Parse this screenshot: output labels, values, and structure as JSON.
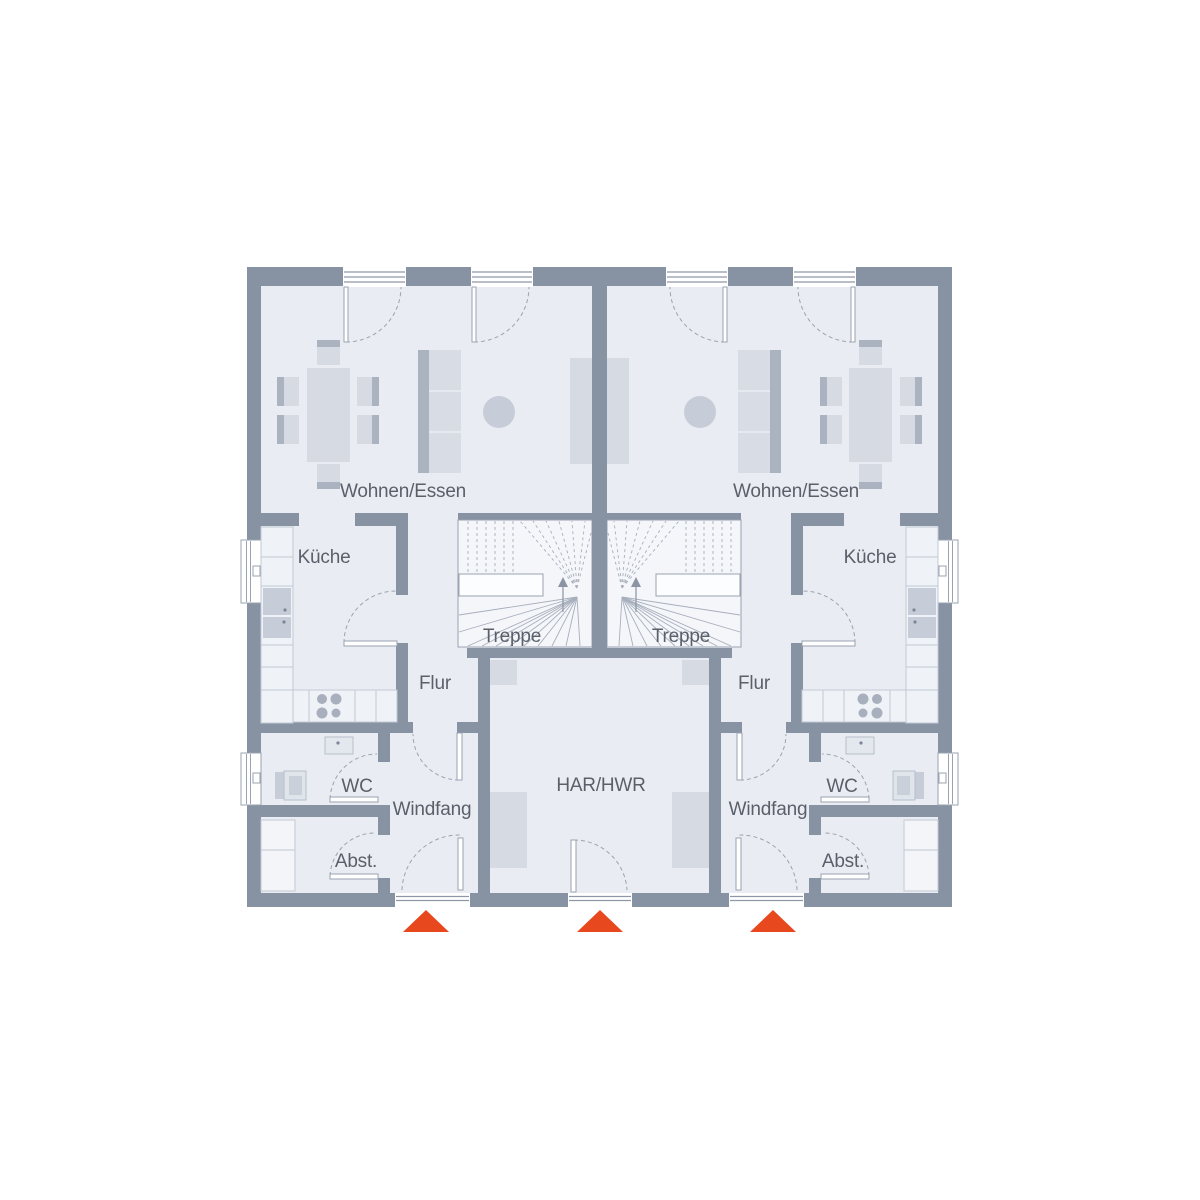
{
  "plan": {
    "type": "floor-plan",
    "description": "Erdgeschoss Doppelhaus (ground floor duplex), two mirrored units with shared central utility room",
    "labels": {
      "left": {
        "living": "Wohnen/Essen",
        "kitchen": "Küche",
        "stairs": "Treppe",
        "hall": "Flur",
        "wc": "WC",
        "vestibule": "Windfang",
        "storage": "Abst."
      },
      "right": {
        "living": "Wohnen/Essen",
        "kitchen": "Küche",
        "stairs": "Treppe",
        "hall": "Flur",
        "wc": "WC",
        "vestibule": "Windfang",
        "storage": "Abst."
      },
      "center": {
        "utility": "HAR/HWR"
      }
    },
    "entrance_arrows": 3,
    "colors": {
      "wall": "#8793A3",
      "floor": "#E9EDF3",
      "furniture": "#D5DAE3",
      "furniture_dark": "#ABB3C1",
      "counter": "#EFF2F6",
      "stairs_fill": "#F4F6FA",
      "label_text": "#5A5F6A",
      "entrance_arrow": "#E8481E"
    }
  }
}
